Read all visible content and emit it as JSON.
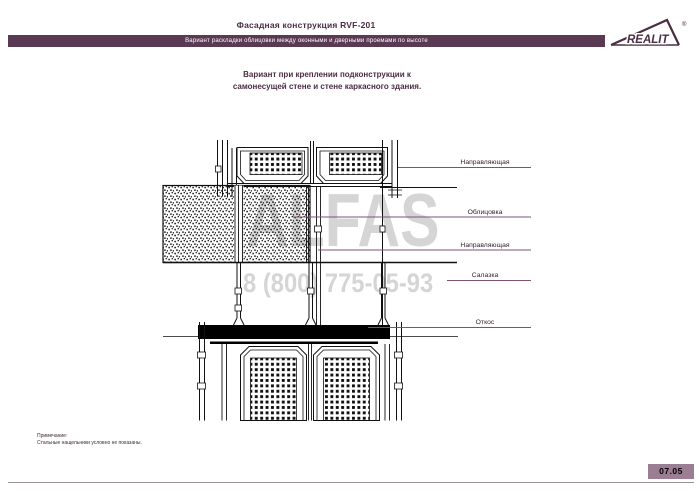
{
  "header": {
    "title": "Фасадная конструкция RVF-201",
    "subtitle": "Вариант раскладки облицовки между оконными и дверными проемами по высоте",
    "logo_text": "REALIT",
    "logo_reg": "®"
  },
  "heading": {
    "line1": "Вариант при креплении подконструкции к",
    "line2": "самонесущей стене и стене каркасного здания."
  },
  "drawing": {
    "callouts": [
      {
        "text": "Направляющая"
      },
      {
        "text": "Облицовка"
      },
      {
        "text": "Направляющая"
      },
      {
        "text": "Салазка"
      },
      {
        "text": "Откос"
      }
    ]
  },
  "watermark": {
    "brand": "ALFAS",
    "phone": "8 (800) 775-05-93"
  },
  "note": {
    "line1": "Примечание:",
    "line2": "Стальные нащельники условно не показаны."
  },
  "footer": {
    "page_number": "07.05"
  },
  "colors": {
    "accent_plum": "#4a2d43",
    "bar_background": "#5a3a52",
    "page_badge_background": "#9b7e94",
    "leader_line": "#7e5273",
    "watermark_gray": "#d5d5d5"
  }
}
